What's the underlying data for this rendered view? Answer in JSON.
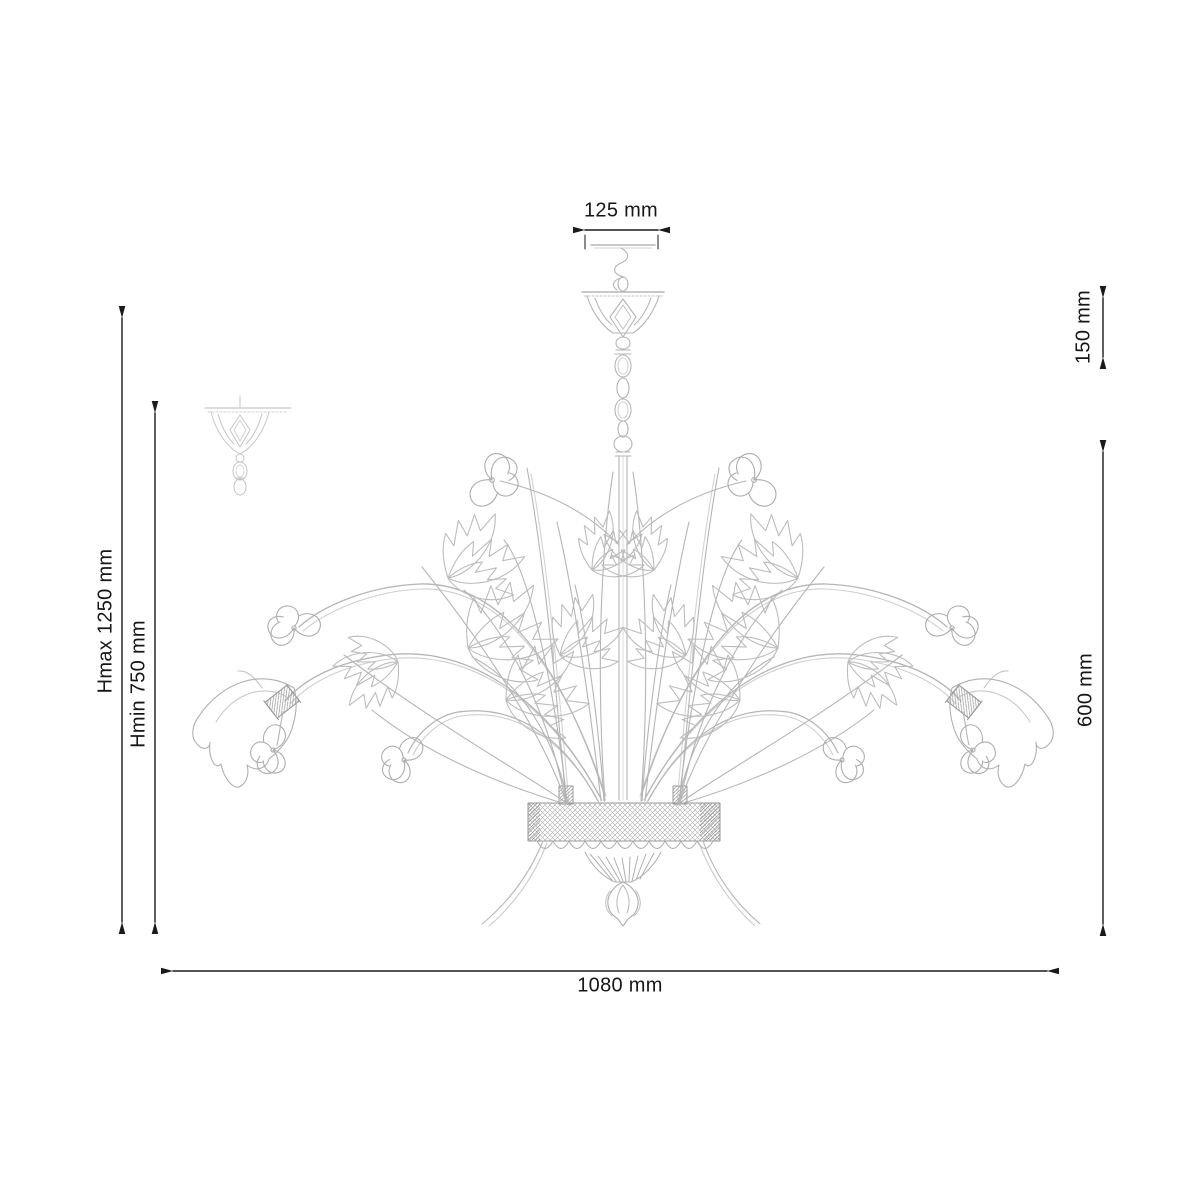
{
  "page": {
    "background": "#ffffff"
  },
  "drawing": {
    "subject": "chandelier technical line drawing with dimension arrows",
    "art_color": "#b5b5b5",
    "dimension_color": "#1a1a1a"
  },
  "dimensions": {
    "canopy_width": {
      "label": "125 mm"
    },
    "canopy_height": {
      "label": "150 mm"
    },
    "max_height": {
      "label": "Hmax 1250 mm"
    },
    "min_height": {
      "label": "Hmin 750 mm"
    },
    "body_height": {
      "label": "600 mm"
    },
    "total_width": {
      "label": "1080 mm"
    }
  }
}
